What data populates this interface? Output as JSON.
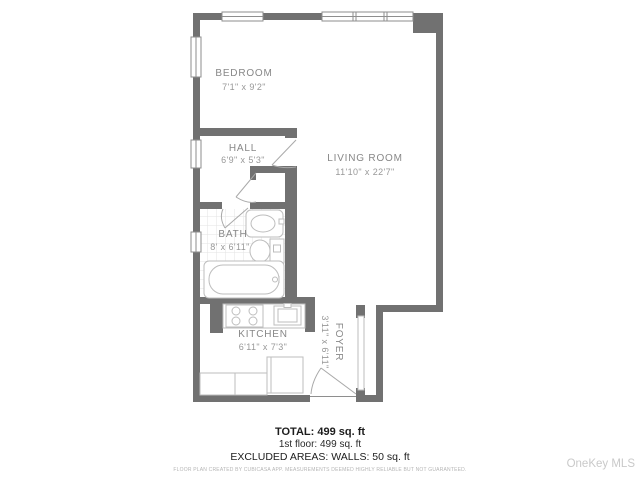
{
  "plan": {
    "rooms": {
      "bedroom": {
        "name": "BEDROOM",
        "dims": "7'1\" x 9'2\""
      },
      "hall": {
        "name": "HALL",
        "dims": "6'9\" x 5'3\""
      },
      "living_room": {
        "name": "LIVING ROOM",
        "dims": "11'10\" x 22'7\""
      },
      "bath": {
        "name": "BATH",
        "dims": "8' x 6'11\""
      },
      "kitchen": {
        "name": "KITCHEN",
        "dims": "6'11\" x 7'3\""
      },
      "foyer": {
        "name": "FOYER",
        "dims": "3'11\" x 6'11\""
      }
    },
    "fixtures": [
      "bathtub",
      "toilet",
      "bathroom-sink",
      "stove",
      "kitchen-sink",
      "fridge",
      "counter",
      "closet"
    ],
    "colors": {
      "wall": "#717171",
      "room_label": "#878787",
      "room_dims": "#989898",
      "fixture_outline": "#bdbdbd",
      "tile_grid": "#e3e3e3",
      "watermark": "#c9c9c9",
      "disclaimer": "#b5b5b5"
    }
  },
  "footer": {
    "total": "TOTAL: 499 sq. ft",
    "floor": "1st floor: 499 sq. ft",
    "excluded": "EXCLUDED AREAS: WALLS: 50 sq. ft",
    "disclaimer": "FLOOR PLAN CREATED BY CUBICASA APP. MEASUREMENTS DEEMED HIGHLY RELIABLE BUT NOT GUARANTEED."
  },
  "watermark": "OneKey MLS"
}
